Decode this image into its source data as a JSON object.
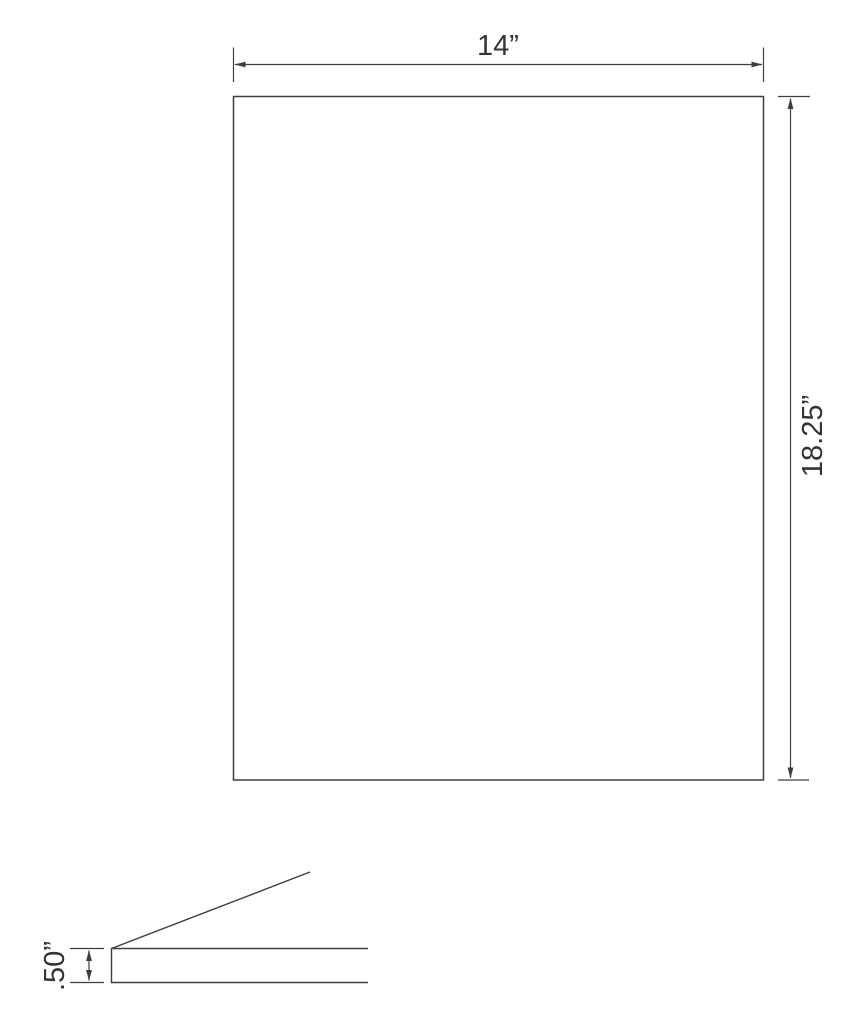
{
  "drawing": {
    "front_view": {
      "width_label": "14”",
      "height_label": "18.25”"
    },
    "profile_view": {
      "thickness_label": ".50”"
    },
    "colors": {
      "line": "#3e3e3e",
      "text": "#343434",
      "background": "#ffffff"
    }
  }
}
